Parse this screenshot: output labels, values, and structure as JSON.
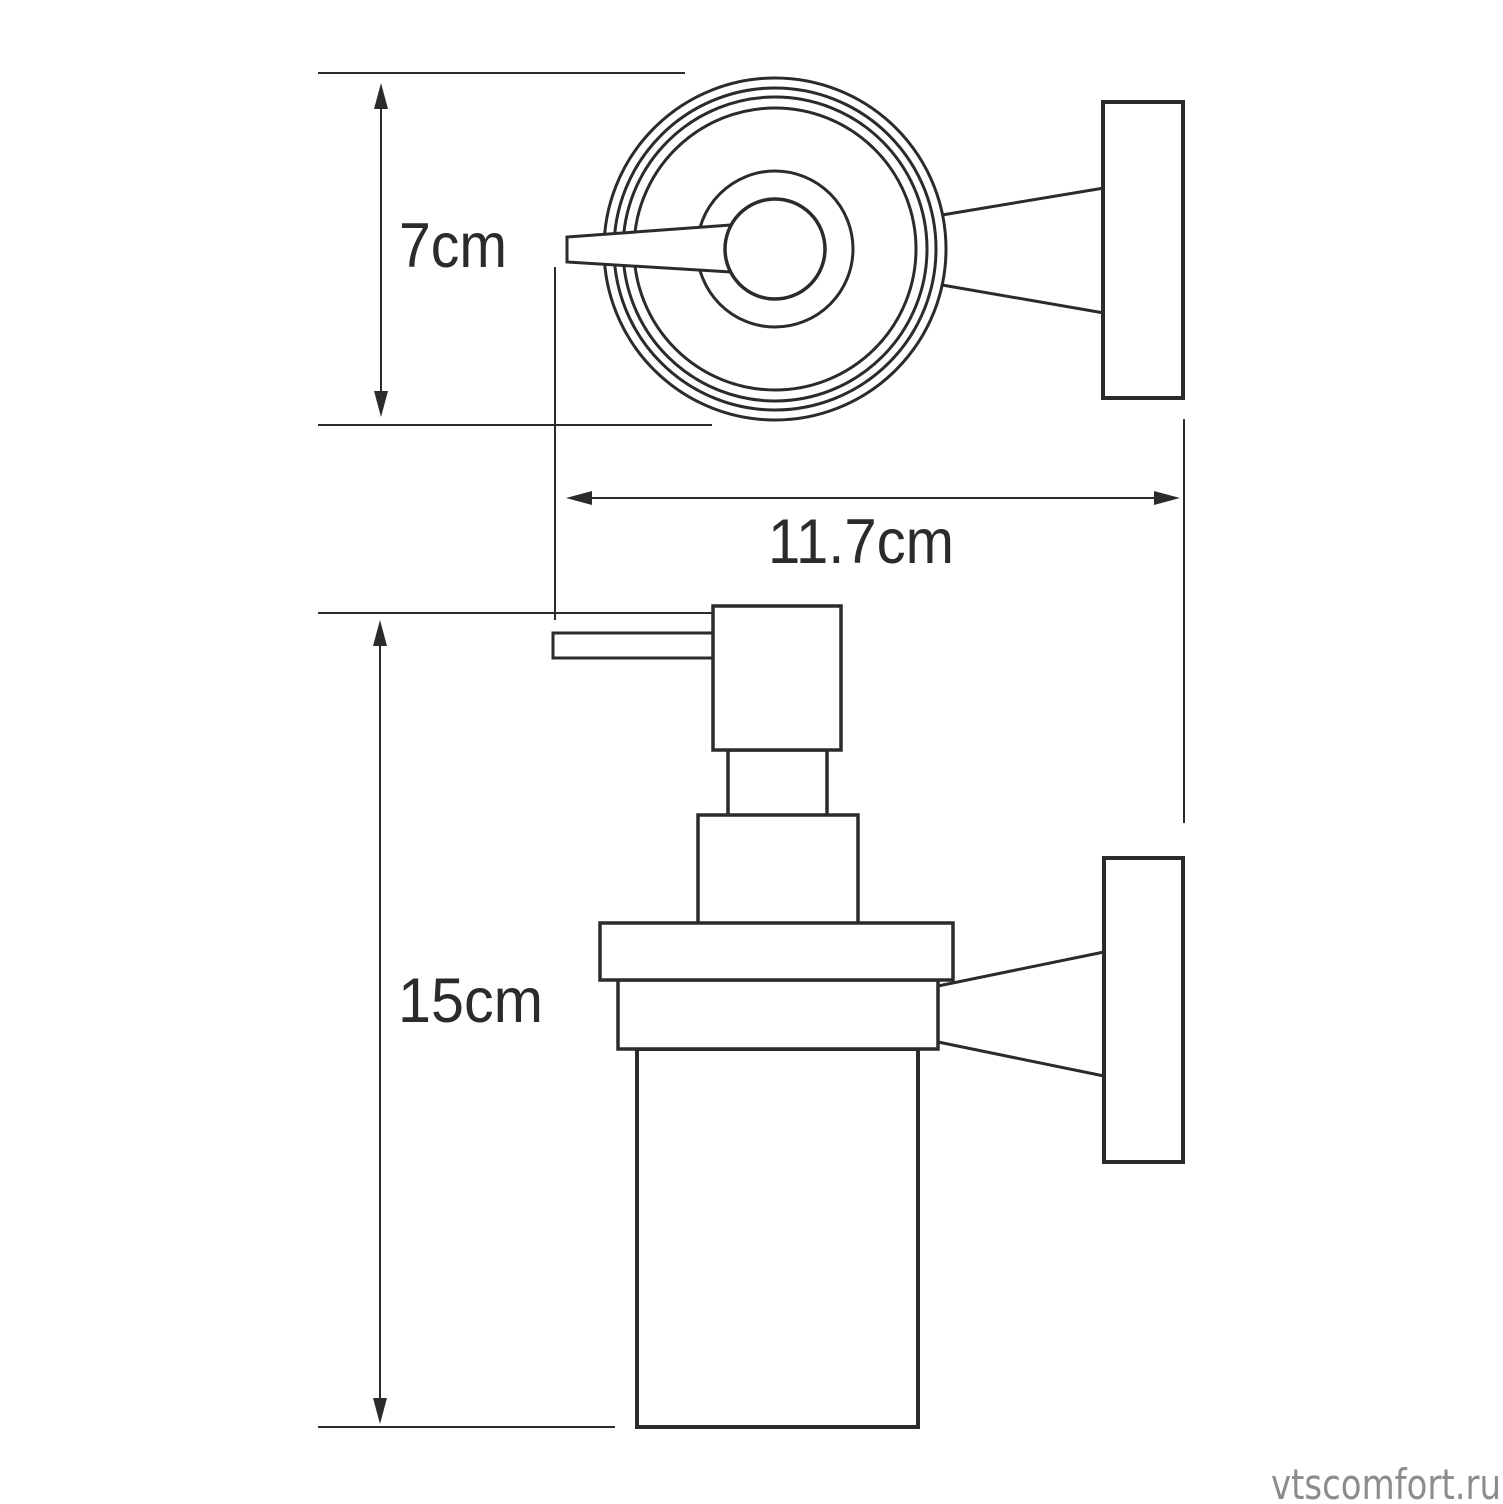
{
  "dimensions": {
    "diameter": "7cm",
    "depth": "11.7cm",
    "height": "15cm"
  },
  "watermark": "vtscomfort.ru",
  "colors": {
    "line": "#2b2b2b",
    "watermark": "#8c8c8c",
    "background": "#ffffff"
  }
}
